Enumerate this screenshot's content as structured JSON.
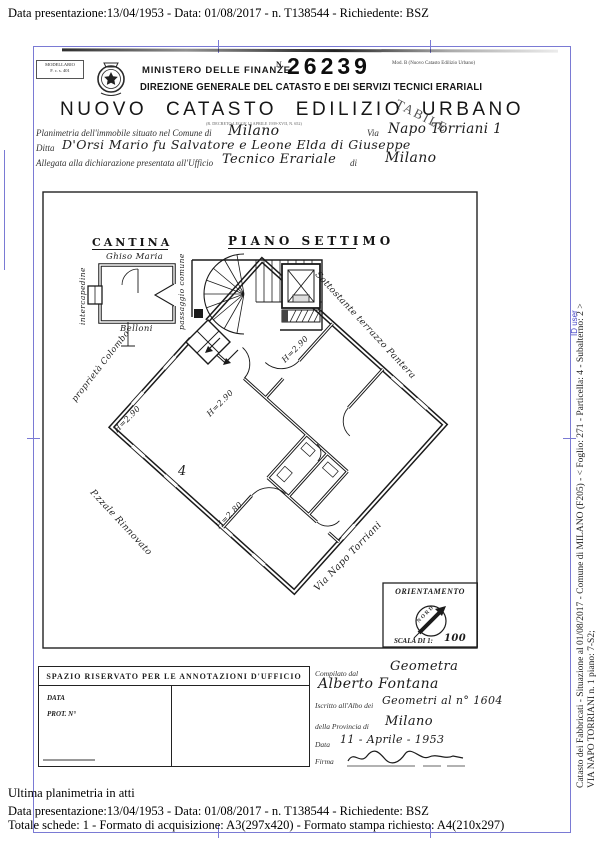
{
  "colors": {
    "border_blue": "#7a7ad4",
    "watermark_blue": "#4848c8",
    "ink": "#1c1c1c"
  },
  "viewer": {
    "top_line": "Data presentazione:13/04/1953 - Data: 01/08/2017 - n. T138544 - Richiedente: BSZ",
    "footer_line1": "Ultima planimetria in atti",
    "footer_line2": "Data presentazione:13/04/1953 - Data: 01/08/2017 - n. T138544 - Richiedente: BSZ",
    "footer_line3": "Totale schede: 1 - Formato di acquisizione: A3(297x420)  - Formato stampa richiesto: A4(210x297)",
    "side_line1": "Catasto dei Fabbricati - Situazione al 01/08/2017 - Comune di MILANO (F205) - < Foglio: 271 - Particella: 4 - Subalterno: 2 >",
    "side_line2": "VIA NAPO TORRIANI n. 1 piano: 7-S2;",
    "side_watermark": "ID user"
  },
  "header": {
    "model_line1": "MODELLARIO",
    "model_line2": "F. c. s. 401",
    "ministry": "MINISTERO DELLE FINANZE",
    "stamp_n": "N.",
    "stamp_number": "26239",
    "model_ref": "Mod. B (Nuovo Catasto Edilizio Urbano)",
    "direction": "DIREZIONE GENERALE DEL CATASTO E DEI SERVIZI TECNICI ERARIALI",
    "title": "NUOVO CATASTO EDILIZIO URBANO",
    "subtitle": "(R. DECRETO-LEGGE 13 APRILE 1939-XVII, N. 652)",
    "stamp_diag": "TABILE"
  },
  "form": {
    "l1a": "Planimetria dell'immobile situato nel Comune di",
    "l1v1": "Milano",
    "l1b": "Via",
    "l1v2": "Napo Torriani 1",
    "l2a": "Ditta",
    "l2v": "D'Orsi Mario fu Salvatore e Leone Elda di Giuseppe",
    "l3a": "Allegata alla dichiarazione presentata all'Ufficio",
    "l3v1": "Tecnico Erariale",
    "l3b": "di",
    "l3v2": "Milano"
  },
  "plan": {
    "cantina_title": "CANTINA",
    "cantina_owner": "Ghiso Maria",
    "cantina_owner2": "Belloni",
    "cantina_left": "intercapedine",
    "cantina_right": "passaggio comune",
    "floor_title": "PIANO SETTIMO",
    "note_terrace": "Sottostante terrazzo Pantera",
    "note_property": "proprietà Colombo",
    "note_square": "P.zzale Rinnovato",
    "note_street": "Via Napo Torriani",
    "h1": "H=2.90",
    "h2": "H=2.90",
    "h3": "H=2.90",
    "h4": "H=2.80",
    "room_no": "4",
    "compass_title": "ORIENTAMENTO",
    "compass_nord": "NORD",
    "scale_label": "SCALA DI 1:",
    "scale_value": "100"
  },
  "office": {
    "header": "SPAZIO RISERVATO PER LE ANNOTAZIONI D'UFFICIO",
    "data_label": "DATA",
    "prot_label": "PROT. N°",
    "compiled_label": "Compilato dal",
    "compiled_v1": "Geometra",
    "compiled_v2": "Alberto Fontana",
    "albo_label": "Iscritto all'Albo dei",
    "albo_v": "Geometri al n° 1604",
    "prov_label": "della Provincia di",
    "prov_v": "Milano",
    "date_label": "Data",
    "date_v": "11 - Aprile - 1953",
    "firma_label": "Firma"
  }
}
